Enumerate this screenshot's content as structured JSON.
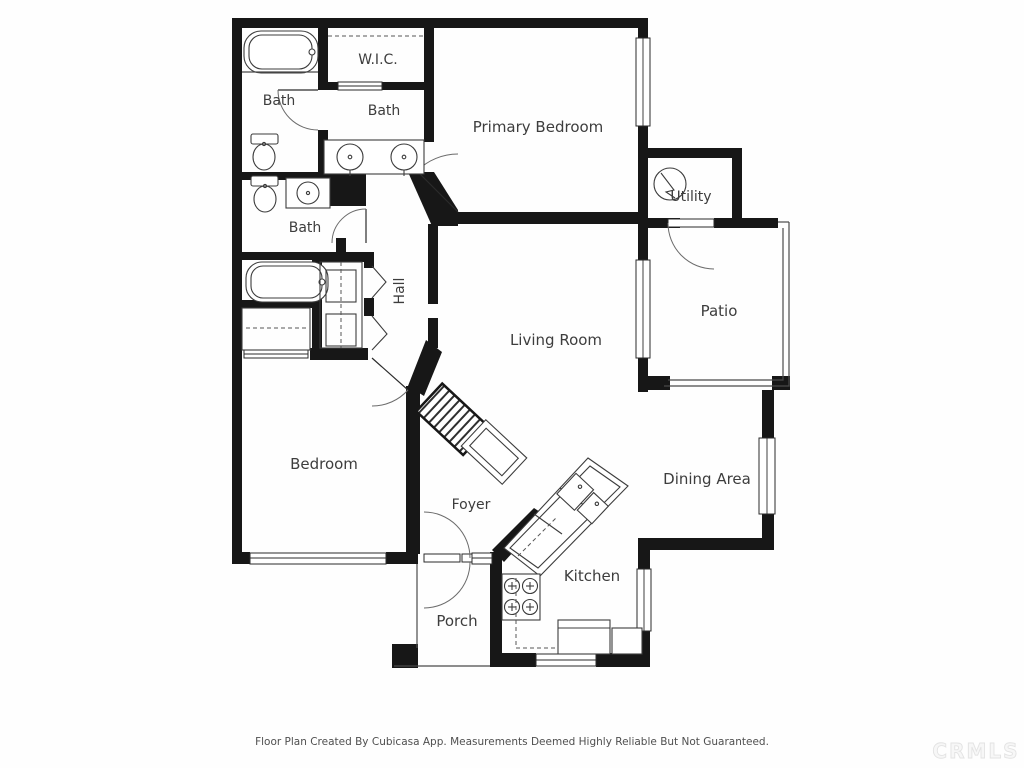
{
  "floor_plan": {
    "rooms": {
      "bath_top_left": "Bath",
      "wic": "W.I.C.",
      "bath_top_middle": "Bath",
      "primary_bedroom": "Primary Bedroom",
      "utility": "Utility",
      "bath_middle_left": "Bath",
      "hall": "Hall",
      "patio": "Patio",
      "living_room": "Living Room",
      "bedroom": "Bedroom",
      "foyer": "Foyer",
      "dining_area": "Dining Area",
      "kitchen": "Kitchen",
      "porch": "Porch"
    },
    "footer": "Floor Plan Created By Cubicasa App. Measurements Deemed Highly Reliable But Not Guaranteed.",
    "watermark": "CRMLS"
  },
  "colors": {
    "wall": "#171717",
    "label": "#3d3d3d",
    "background": "#fefefe",
    "watermark_stroke": "#e3e3e3"
  }
}
